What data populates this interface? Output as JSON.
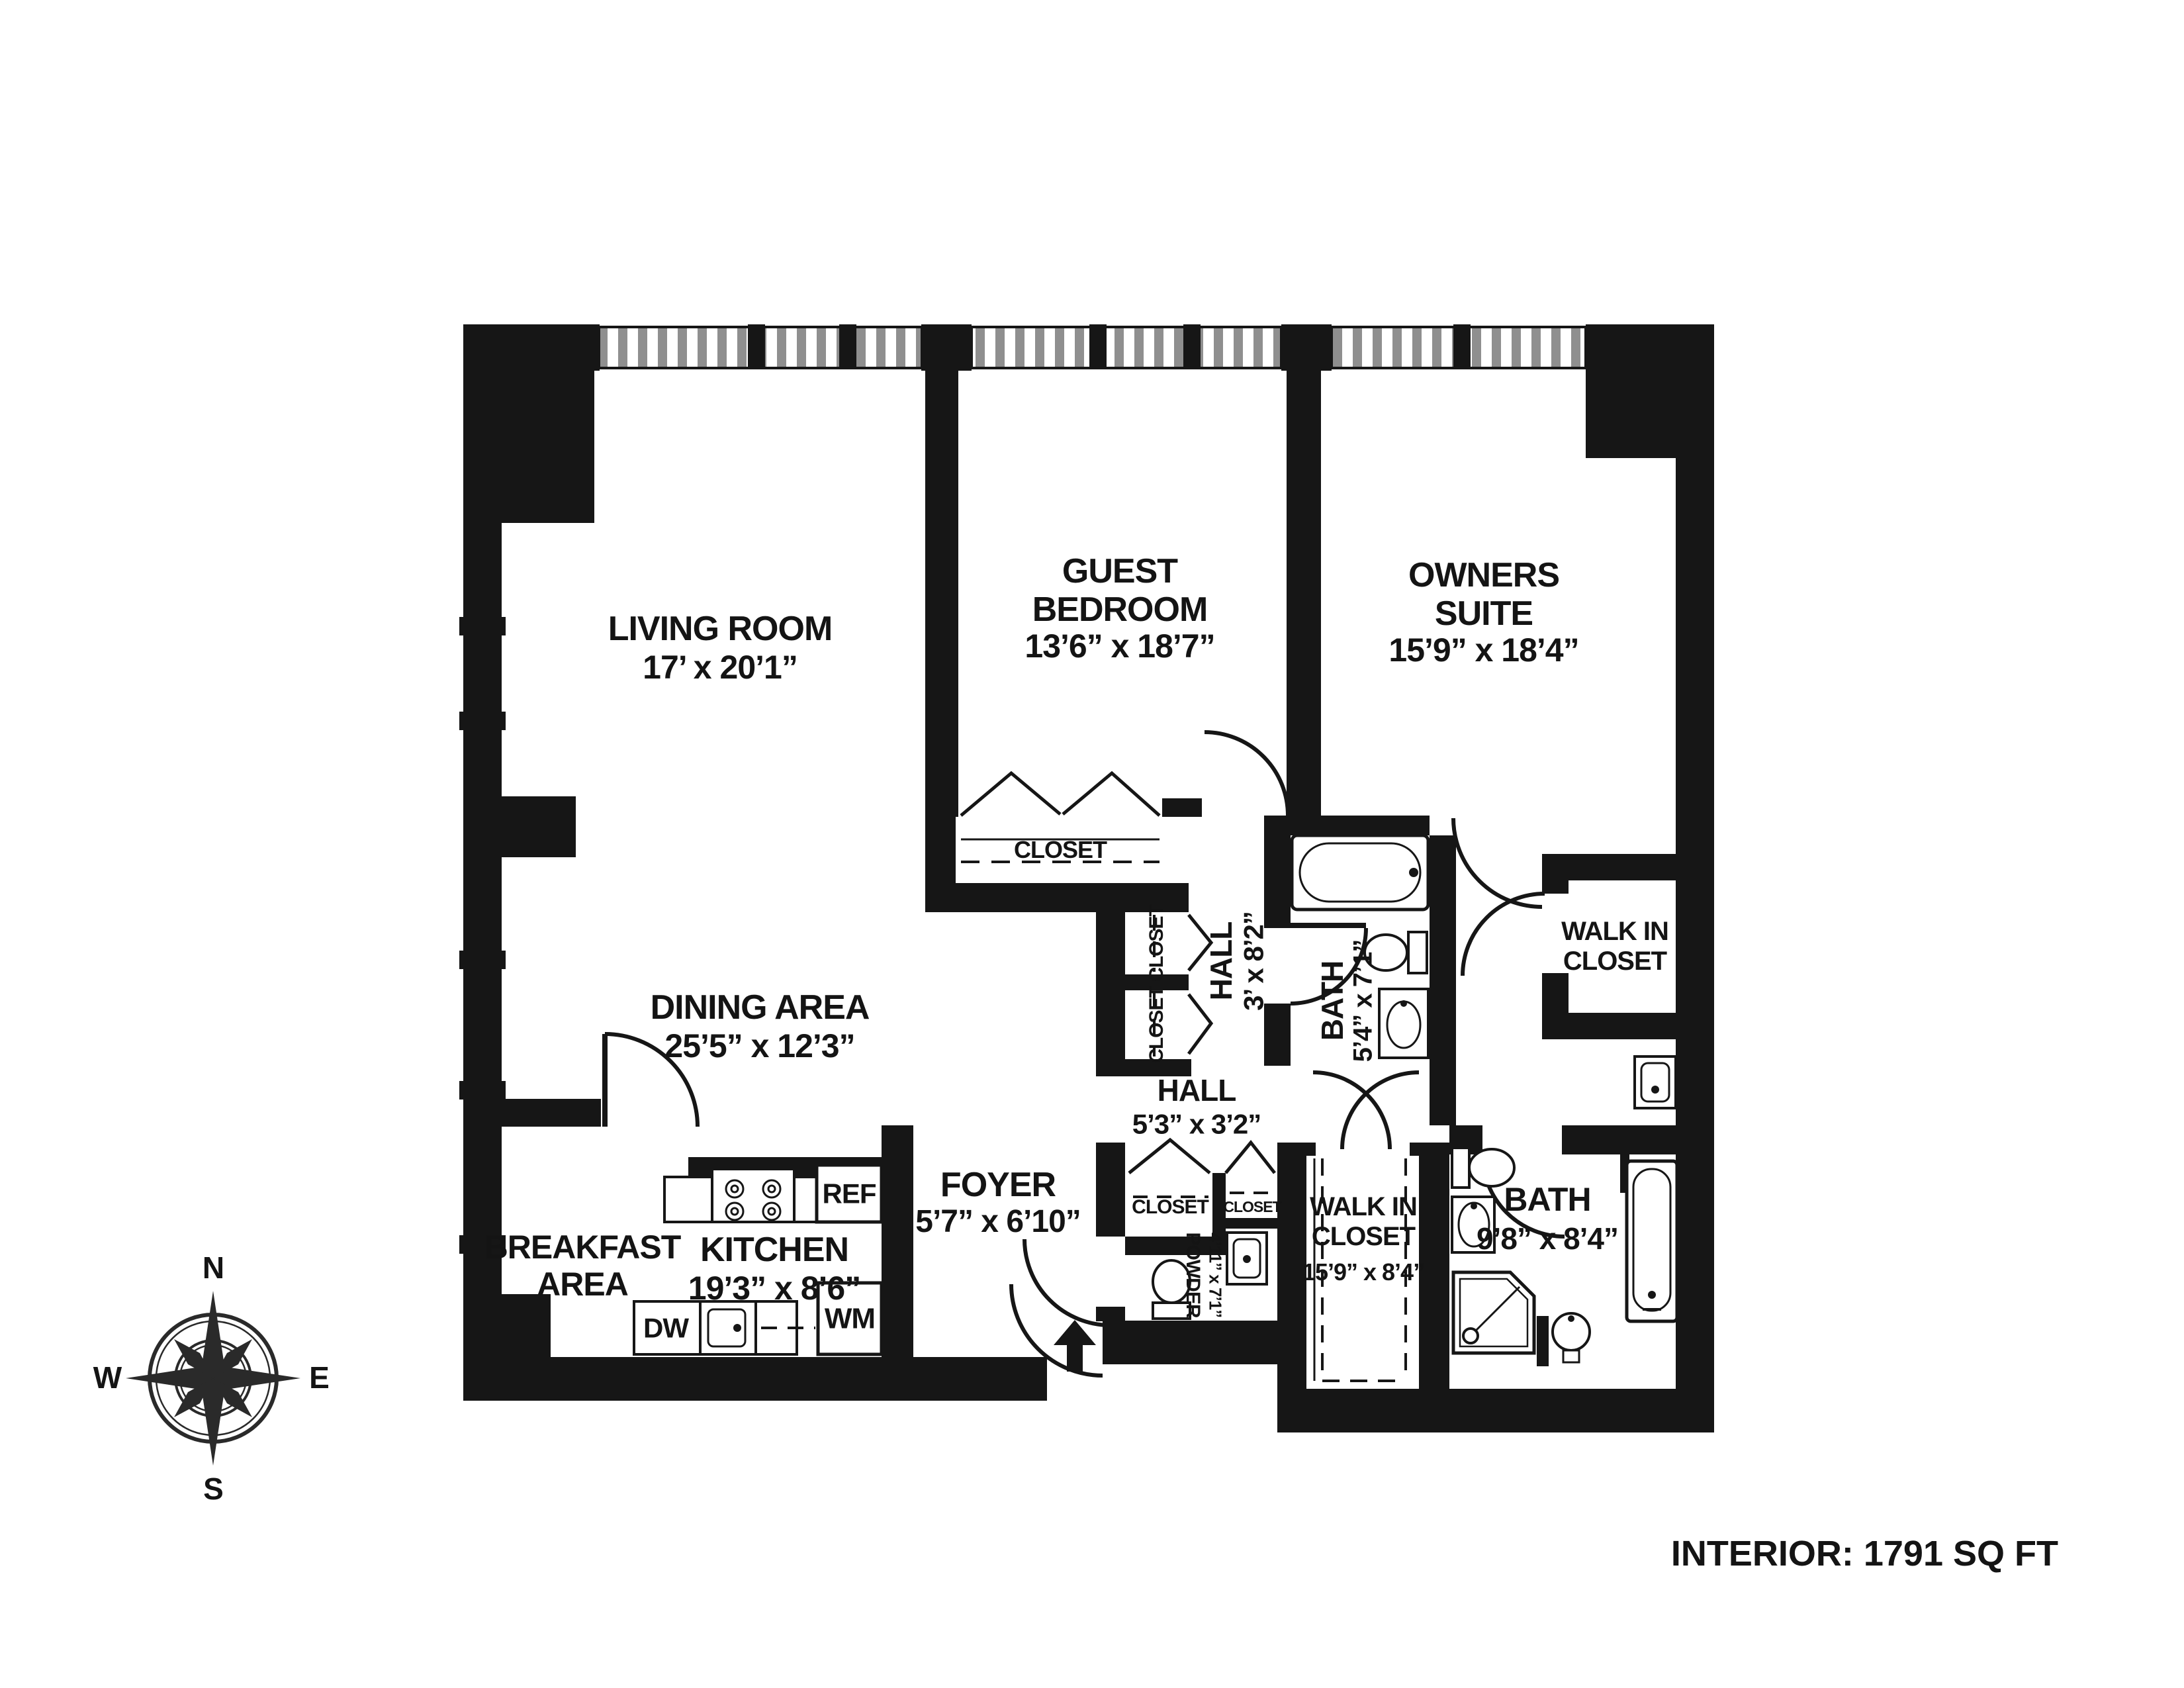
{
  "plan": {
    "footer": "INTERIOR: 1791 SQ FT",
    "compass": {
      "n": "N",
      "e": "E",
      "s": "S",
      "w": "W"
    },
    "rooms": {
      "living_room": {
        "name": "LIVING ROOM",
        "dims": "17’ x 20’1”"
      },
      "guest_bedroom": {
        "name": "GUEST BEDROOM",
        "dims": "13’6” x 18’7”"
      },
      "owners_suite": {
        "name": "OWNERS SUITE",
        "dims": "15’9” x 18’4”"
      },
      "dining_area": {
        "name": "DINING AREA",
        "dims": "25’5” x 12’3”"
      },
      "breakfast_area": {
        "name": "BREAKFAST AREA"
      },
      "kitchen": {
        "name": "KITCHEN",
        "dims": "19’3” x 8’6”"
      },
      "foyer": {
        "name": "FOYER",
        "dims": "5’7” x 6’10”"
      },
      "hall_upper": {
        "name": "HALL",
        "dims": "3’ x 8’2”"
      },
      "hall_lower": {
        "name": "HALL",
        "dims": "5’3” x 3’2”"
      },
      "bath_upper": {
        "name": "BATH",
        "dims": "5’4” x 7’1”"
      },
      "powder_room": {
        "name": "POWDER",
        "dims": "4’11” x 7’1”"
      },
      "walk_in_closet_upper": {
        "name": "WALK IN CLOSET"
      },
      "walk_in_closet_lower": {
        "name": "WALK IN CLOSET",
        "dims": "15’9” x 8’4”"
      },
      "bath_lower": {
        "name": "BATH",
        "dims": "9’8” x 8’4”"
      }
    },
    "closets": {
      "guest": "CLOSET",
      "hall_upper_1": "CLOSET",
      "hall_upper_2": "CLOSET",
      "hall_lower_1": "CLOSET",
      "hall_lower_2": "CLOSET"
    },
    "appliances": {
      "refrigerator": "REF",
      "dishwasher": "DW",
      "washing_machine": "WM"
    }
  }
}
